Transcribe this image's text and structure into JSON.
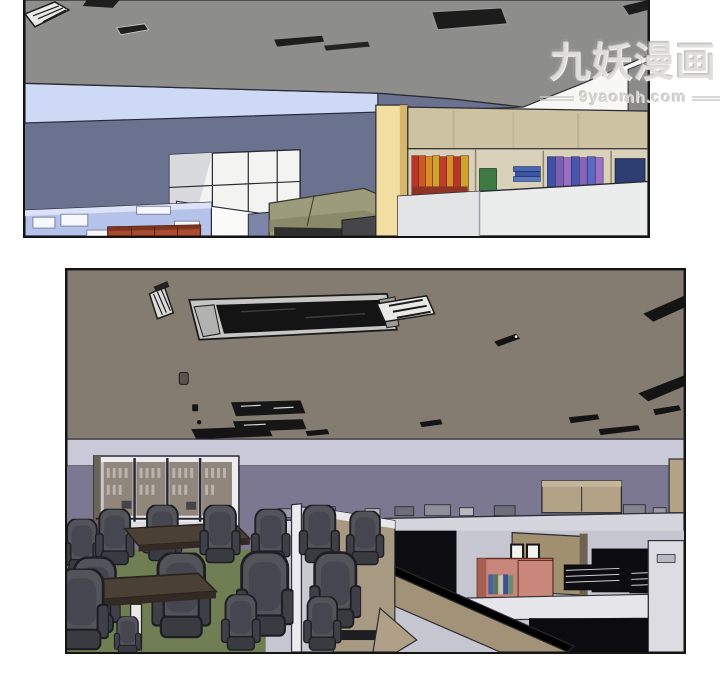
{
  "watermark": {
    "title": "九妖漫画",
    "site": "9yaomh.com"
  },
  "panels": [
    {
      "id": "panel-1",
      "alt": "3D rendered office interior: gray ceiling with dark vents and a striped light fixture, light-blue wall strip over a slate-blue wall, white grid partition screen, periwinkle cubicle desks, brick-red sideboard, olive couch, pale-yellow pillar and a wooden bookshelf filled with red, orange, yellow, green, blue and purple books behind white partitions"
    },
    {
      "id": "panel-2",
      "alt": "3D rendered office interior: taupe ceiling with a large dark air vent, striped lights and scattered dark vents, lavender wall band over a gray-purple wall, glass-front cabinets, meeting tables with many dark office chairs on green carpet, and a cubicle farm with tan partitions, a salmon bookshelf with books, picture frames and wire racks"
    }
  ],
  "palette": {
    "page_background": "#ffffff",
    "panel_border": "#141414",
    "panel1_ceiling": "#8d8d8b",
    "panel1_sky_band": "#cdd9f5",
    "panel1_wall": "#6b7290",
    "panel1_partition": "#f3f3f1",
    "panel1_cubicles": "#b5c2ea",
    "panel1_sideboard": "#a84b30",
    "panel1_couch": "#9c9c7c",
    "panel1_pillar": "#f3dea1",
    "panel1_shelf_wood": "#cdc2a2",
    "panel1_shelf_back": "#d9d1b9",
    "book_red": "#b93527",
    "book_orange": "#d88d28",
    "book_green": "#3f7a45",
    "book_blue": "#3f51a5",
    "book_purple": "#9b6fc5",
    "panel2_ceiling": "#857c71",
    "panel2_wall_band": "#c9c9d8",
    "panel2_wall": "#7d7892",
    "panel2_carpet": "#6f7e53",
    "panel2_chair": "#53535a",
    "panel2_table": "#4a4036",
    "panel2_cabinet_frame": "#ecebef",
    "panel2_cubicle_face": "#c9c9d2",
    "panel2_cubicle_tan": "#a89a82",
    "panel2_shelf_salmon": "#c9867a",
    "vent_dark": "#141414"
  }
}
